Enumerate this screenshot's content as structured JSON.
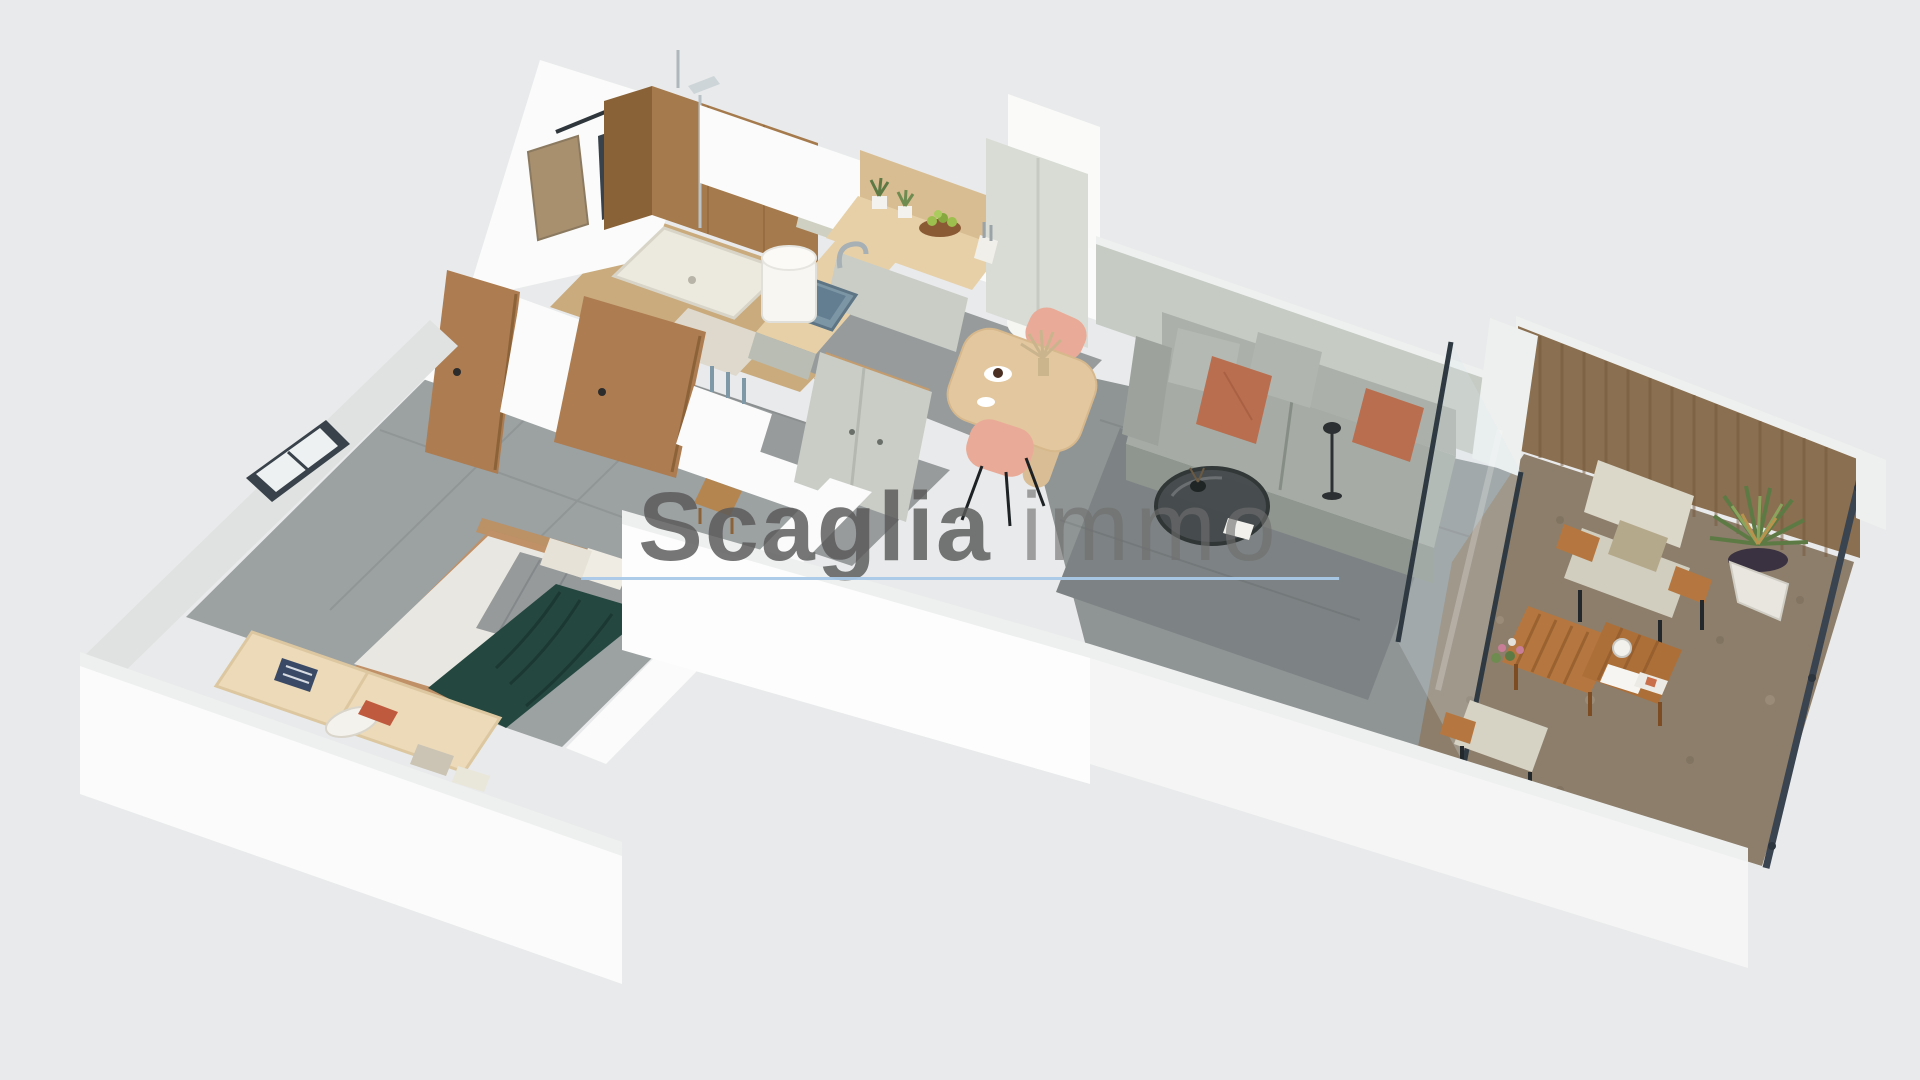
{
  "watermark": {
    "brand": "Scaglia",
    "suffix": "immo"
  },
  "colors": {
    "background": "#e9eaeb",
    "wall-white": "#fafbfa",
    "wall-top": "#eef0ef",
    "wall-shadow": "#e0e2e1",
    "wall-green": "#c6cbc4",
    "floor-tile": "#979b9c",
    "floor-rug": "#7d8384",
    "floor-bath": "#c9ab7e",
    "floor-terrace": "#8c7e6b",
    "wood-door": "#ad7c50",
    "wood-slat-wall": "#8a6f50",
    "wood-furniture": "#b5773f",
    "counter-wood": "#e7d0a8",
    "cabinet-front": "#c9cdc6",
    "sofa-gray": "#a6aca5",
    "pillow-terracotta": "#b96e4f",
    "chair-pink": "#e9ab97",
    "bed-teal": "#24473f",
    "plant-green": "#5d7a45",
    "underline-blue": "#a9c9e8",
    "watermark-gray": "#595959"
  },
  "scene": {
    "type": "3d-floor-plan-render",
    "rooms": [
      "bathroom",
      "hallway",
      "kitchen",
      "dining-area",
      "living-room",
      "bedroom",
      "terrace"
    ],
    "furniture": [
      "shower",
      "water-heater",
      "toilet",
      "mirror",
      "kitchen-counter",
      "kitchen-sink",
      "tall-cabinet",
      "dining-table",
      "dining-chairs",
      "wardrobe",
      "sofa",
      "coffee-table",
      "floor-lamp",
      "glass-partition",
      "outdoor-armchairs",
      "outdoor-coffee-table",
      "potted-palm",
      "bed",
      "storage-bench",
      "wood-doors",
      "windows",
      "balcony-railing"
    ]
  }
}
